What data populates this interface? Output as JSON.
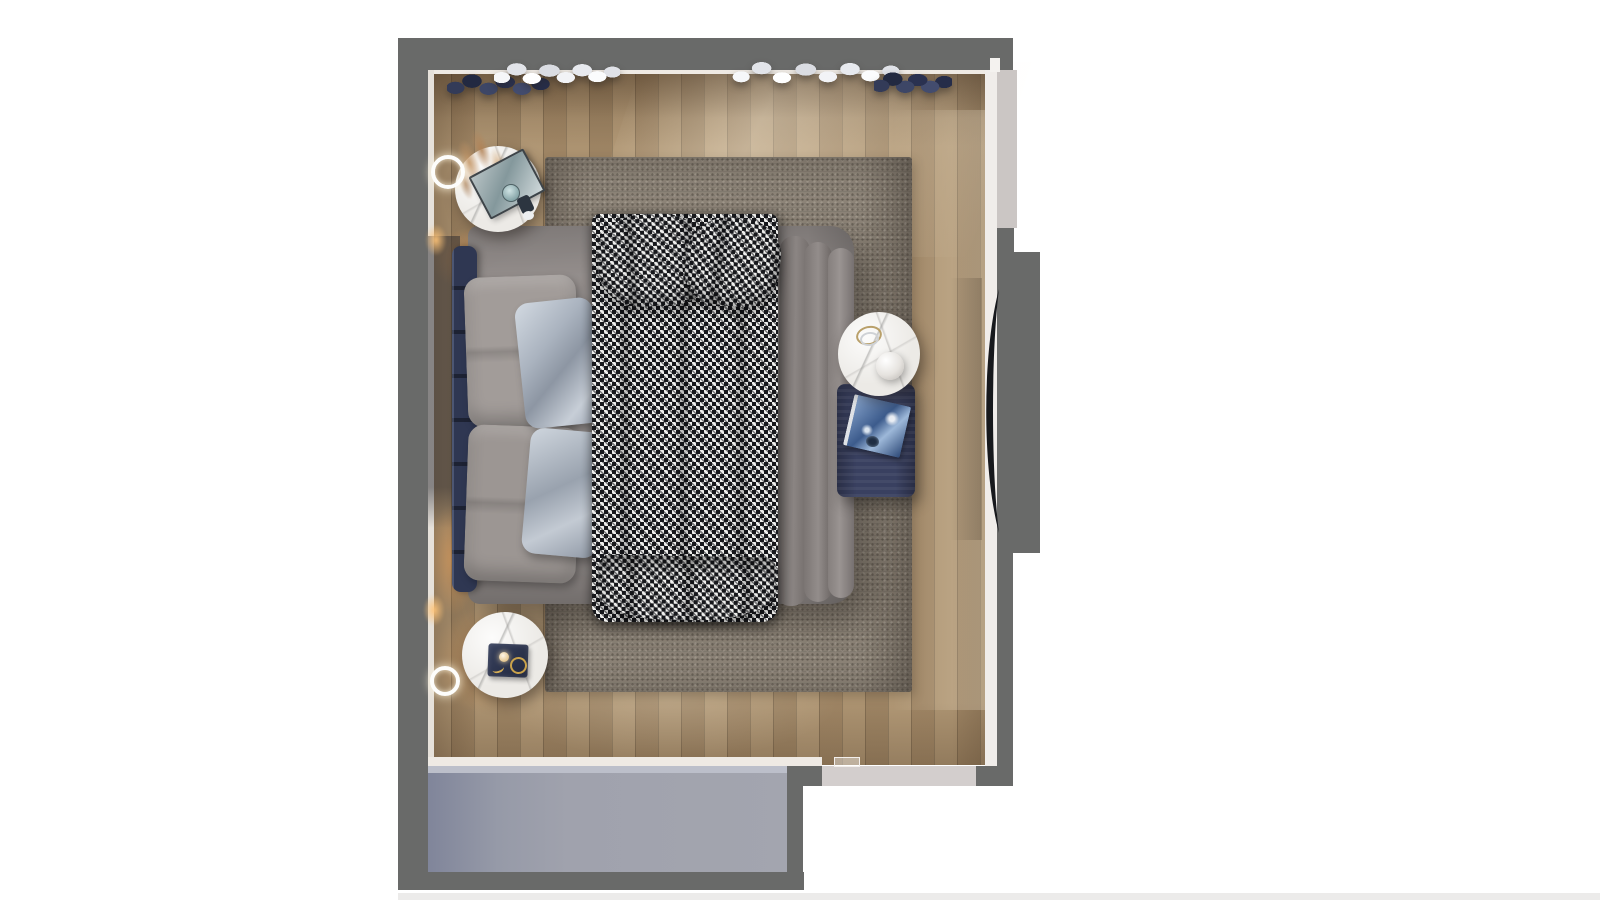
{
  "scene": {
    "type": "3d-render-top-view",
    "room": "bedroom floor plan, bird's-eye render on white background",
    "canvas": {
      "width": 1600,
      "height": 900,
      "background": "#ffffff"
    },
    "colors": {
      "wall": "#696a69",
      "wall_inner_face": "#efeae4",
      "floor": "#a78d6b",
      "rug": "#8d8478",
      "duvet": "#8f8987",
      "headboard_navy": "#2f3752",
      "pillow_linen": "#a29c99",
      "pillow_satin": "#b9c1cb",
      "houndstooth_dark": "#17181c",
      "houndstooth_light": "#efefed",
      "marble": "#eceae6",
      "ottoman_navy": "#394060",
      "book_blue": "#4c6da1",
      "lower_slab": "#9fa1ad",
      "threshold": "#d3cecd",
      "window_band": "#cbc6c4",
      "tv_black": "#17191d",
      "warm_light": "#ffac5a",
      "clothes_white": "#eef0f3",
      "clothes_navy": "#2d3450",
      "gold": "#c9a24b"
    },
    "objects": [
      {
        "name": "walls",
        "label": "Dark gray room walls with door opening at bottom right"
      },
      {
        "name": "wood-floor",
        "label": "Oak plank floor, vertical planks"
      },
      {
        "name": "area-rug",
        "label": "Large gray textured area rug under bed"
      },
      {
        "name": "bed",
        "label": "Double bed with warm-gray duvet and ruffled right edge"
      },
      {
        "name": "headboard",
        "label": "Navy slatted headboard on left side of bed"
      },
      {
        "name": "pillows-linen",
        "label": "Two large gray linen pillows"
      },
      {
        "name": "pillows-satin",
        "label": "Two silver satin accent pillows"
      },
      {
        "name": "houndstooth-throw",
        "label": "Black and white houndstooth throw runner with folded cushions"
      },
      {
        "name": "nightstand-top",
        "label": "Round white nightstand with mirrored tray, glass decor and dried pampas plant"
      },
      {
        "name": "nightstand-bottom",
        "label": "Round white nightstand with dark jewelry tray, gold ring and small lamp"
      },
      {
        "name": "side-table-marble",
        "label": "Round marble side table with stacked rings and white sphere bowl lamp"
      },
      {
        "name": "ottoman-bench",
        "label": "Navy fabric ottoman with blue-marbled book"
      },
      {
        "name": "wall-ring-light-top",
        "label": "Glowing ring wall sconce, upper left"
      },
      {
        "name": "wall-ring-light-bottom",
        "label": "Glowing ring wall sconce, lower left"
      },
      {
        "name": "wall-glow-strips",
        "label": "Warm LED glow spots along left wall"
      },
      {
        "name": "clothes-rail-left",
        "label": "Hanging clothes along top wall: navy pile and white garments"
      },
      {
        "name": "clothes-rail-right",
        "label": "Hanging clothes along top wall: white garments and navy pile"
      },
      {
        "name": "tv-panel",
        "label": "Curved black TV panel on right wall (seen edge-on)"
      },
      {
        "name": "window-right",
        "label": "Light gray window/sill band in upper right wall"
      },
      {
        "name": "door-opening",
        "label": "Door opening with light threshold, bottom right"
      },
      {
        "name": "lower-slab",
        "label": "Blue-gray adjacent volume below the room (wardrobe/hall block)"
      },
      {
        "name": "bottom-edge-strip",
        "label": "Faint gray strip along bottom edge of render"
      }
    ]
  }
}
